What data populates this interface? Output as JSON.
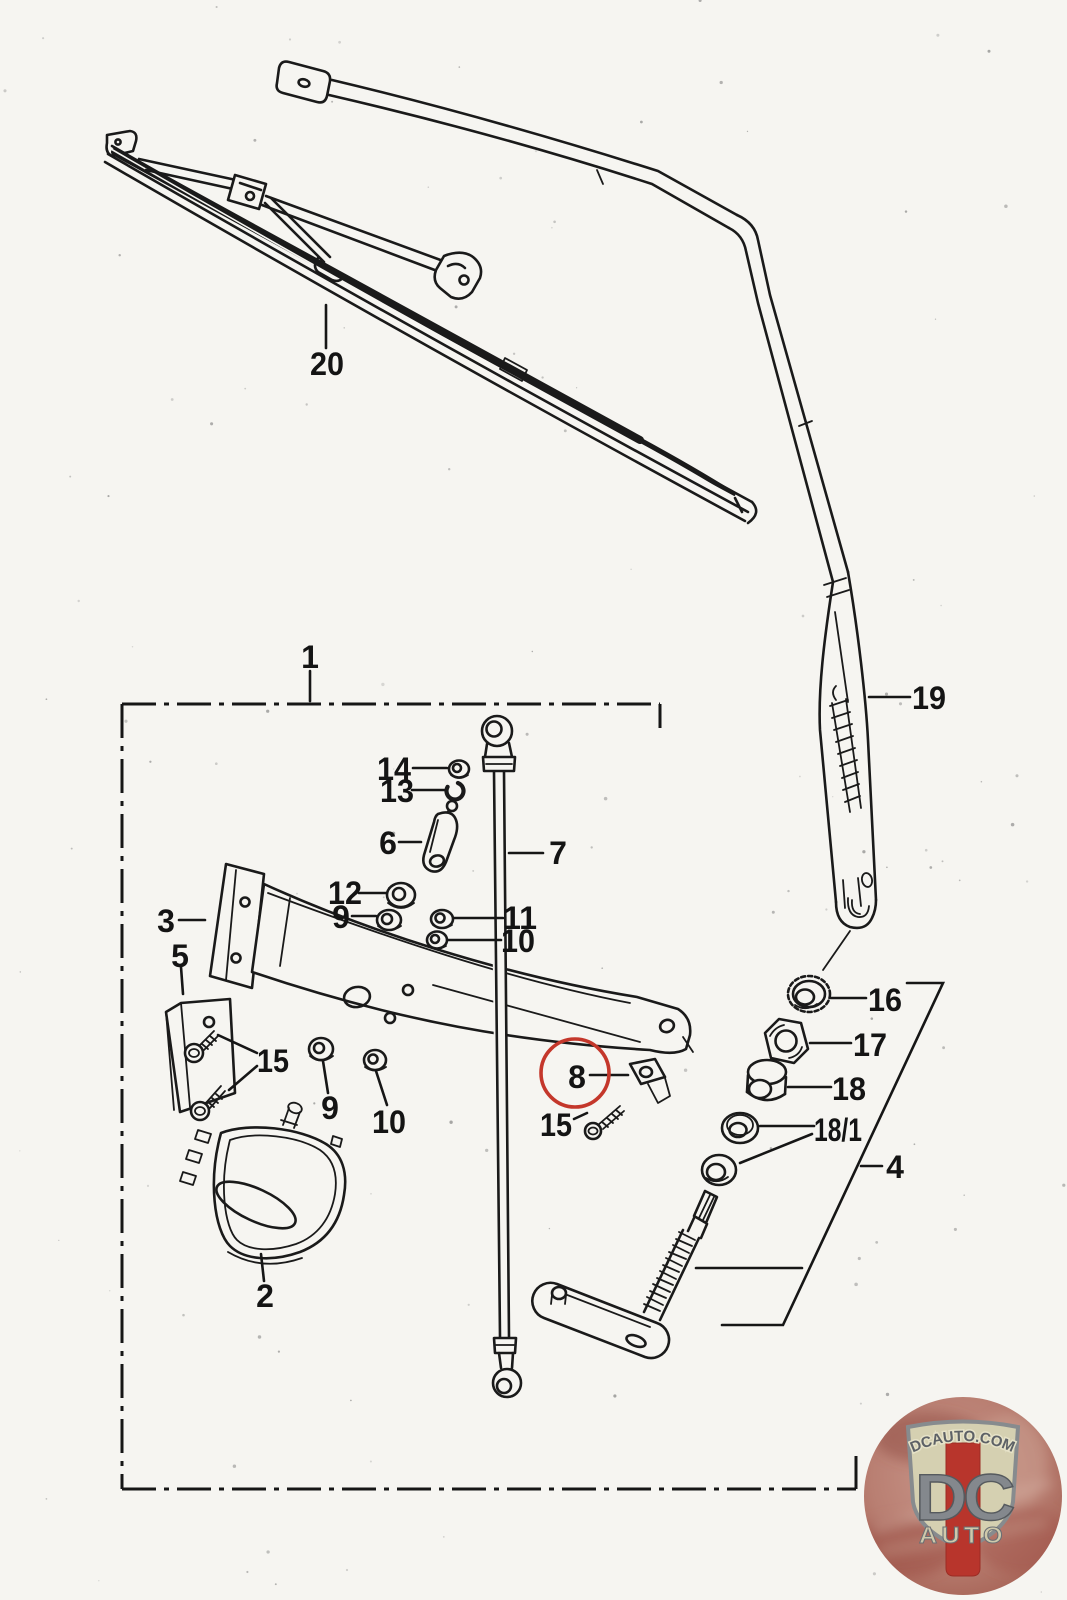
{
  "callouts": {
    "c20": "20",
    "c19": "19",
    "c1": "1",
    "c14": "14",
    "c13": "13",
    "c6": "6",
    "c7": "7",
    "c3": "3",
    "c12": "12",
    "c9_upper": "9",
    "c11": "11",
    "c10_upper": "10",
    "c5": "5",
    "c15_left": "15",
    "c9_lower": "9",
    "c10_lower": "10",
    "c2": "2",
    "c8": "8",
    "c15_right": "15",
    "c16": "16",
    "c17": "17",
    "c18": "18",
    "c18_1": "18/1",
    "c4": "4"
  },
  "highlight": {
    "circled_part": "8",
    "color": "#c4372b"
  },
  "watermark": {
    "site": "DCAUTO.COM",
    "monogram": "DC",
    "word": "AUTO",
    "colors": {
      "badge_background": "#b97f72",
      "shield": "#d5d0b1",
      "stripe": "#b8352c",
      "letters": "#84888d",
      "border": "#878b8e"
    }
  }
}
